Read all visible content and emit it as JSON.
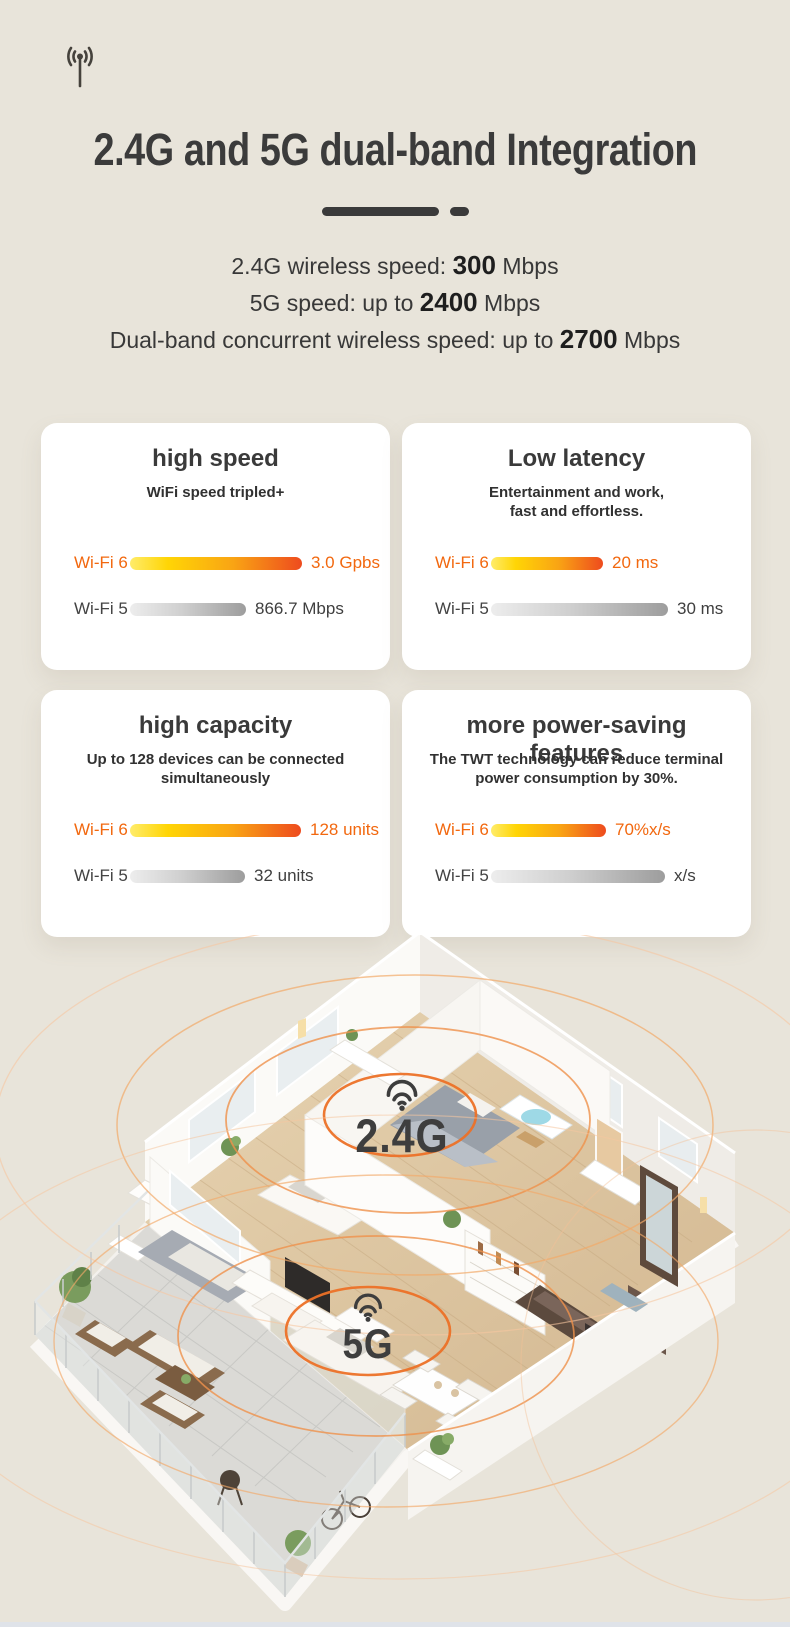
{
  "page": {
    "background": "#e8e4da",
    "bottom_strip_color": "#dfe3e9"
  },
  "header": {
    "icon": "antenna-broadcast-icon",
    "title": "2.4G and 5G dual-band Integration"
  },
  "specs": [
    {
      "pre": "2.4G wireless speed: ",
      "strong": "300",
      "post": " Mbps"
    },
    {
      "pre": "5G speed: up to ",
      "strong": "2400",
      "post": " Mbps"
    },
    {
      "pre": "Dual-band concurrent wireless speed: up to ",
      "strong": "2700",
      "post": " Mbps"
    }
  ],
  "cards": [
    {
      "title": "high speed",
      "subtitle": "WiFi speed tripled+",
      "rows": [
        {
          "label": "Wi-Fi 6",
          "value": "3.0 Gpbs",
          "bar_px": 172,
          "variant": "wifi6"
        },
        {
          "label": "Wi-Fi 5",
          "value": "866.7 Mbps",
          "bar_px": 116,
          "variant": "wifi5"
        }
      ]
    },
    {
      "title": "Low latency",
      "subtitle": "Entertainment and work,\nfast and effortless.",
      "rows": [
        {
          "label": "Wi-Fi 6",
          "value": "20 ms",
          "bar_px": 112,
          "variant": "wifi6"
        },
        {
          "label": "Wi-Fi 5",
          "value": "30 ms",
          "bar_px": 177,
          "variant": "wifi5"
        }
      ]
    },
    {
      "title": "high capacity",
      "subtitle": "Up to 128 devices can be connected\nsimultaneously",
      "rows": [
        {
          "label": "Wi-Fi 6",
          "value": "128 units",
          "bar_px": 171,
          "variant": "wifi6"
        },
        {
          "label": "Wi-Fi 5",
          "value": "32 units",
          "bar_px": 115,
          "variant": "wifi5"
        }
      ]
    },
    {
      "title": "more power-saving features",
      "subtitle": "The TWT technology can reduce terminal\npower consumption by 30%.",
      "rows": [
        {
          "label": "Wi-Fi 6",
          "value": "70%x/s",
          "bar_px": 115,
          "variant": "wifi6"
        },
        {
          "label": "Wi-Fi 5",
          "value": "x/s",
          "bar_px": 174,
          "variant": "wifi5"
        }
      ]
    }
  ],
  "floorplan": {
    "labels": [
      {
        "icon": "wifi-signal-icon",
        "text": "2.4G"
      },
      {
        "icon": "wifi-signal-icon",
        "text": "5G"
      }
    ]
  },
  "chart_data": [
    {
      "type": "bar",
      "title": "high speed",
      "subtitle": "WiFi speed tripled+",
      "categories": [
        "Wi-Fi 6",
        "Wi-Fi 5"
      ],
      "values": [
        3000,
        866.7
      ],
      "unit": "Mbps",
      "value_labels": [
        "3.0 Gpbs",
        "866.7 Mbps"
      ],
      "legend_position": "left",
      "grid": false
    },
    {
      "type": "bar",
      "title": "Low latency",
      "subtitle": "Entertainment and work, fast and effortless.",
      "categories": [
        "Wi-Fi 6",
        "Wi-Fi 5"
      ],
      "values": [
        20,
        30
      ],
      "unit": "ms",
      "value_labels": [
        "20 ms",
        "30 ms"
      ],
      "legend_position": "left",
      "grid": false
    },
    {
      "type": "bar",
      "title": "high capacity",
      "subtitle": "Up to 128 devices can be connected simultaneously",
      "categories": [
        "Wi-Fi 6",
        "Wi-Fi 5"
      ],
      "values": [
        128,
        32
      ],
      "unit": "units",
      "value_labels": [
        "128 units",
        "32 units"
      ],
      "legend_position": "left",
      "grid": false
    },
    {
      "type": "bar",
      "title": "more power-saving features",
      "subtitle": "The TWT technology can reduce terminal power consumption by 30%.",
      "categories": [
        "Wi-Fi 6",
        "Wi-Fi 5"
      ],
      "values": [
        70,
        null
      ],
      "unit": "%x/s",
      "value_labels": [
        "70%x/s",
        "x/s"
      ],
      "legend_position": "left",
      "grid": false
    }
  ],
  "colors": {
    "background": "#e8e4da",
    "accent_orange": "#f2680f",
    "wifi6_bar_start": "#ffec6a",
    "wifi6_bar_end": "#ee4b1e",
    "wifi5_bar": "#9d9d9d",
    "heading_text": "#3b3b3b",
    "ripple_orange": "#ec7127",
    "bottom_strip": "#dfe3e9"
  }
}
